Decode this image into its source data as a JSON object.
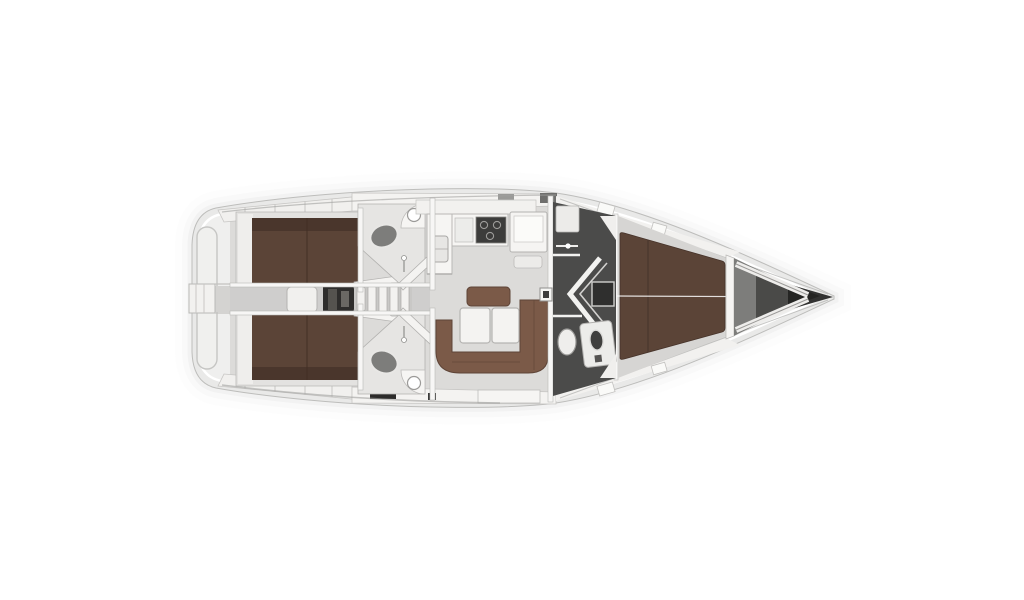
{
  "page": {
    "background": "#ffffff",
    "subject": "sailboat-interior-floor-plan-top-view-bow-right"
  },
  "colors": {
    "hull": "#e9e9e8",
    "hullEdge": "#bdbdbb",
    "deck": "#f3f2f0",
    "deckSeam": "#c7c6c4",
    "floor": "#dcdbd9",
    "corridor": "#d2d1cf",
    "wall": "#f7f6f5",
    "berth": "#5b4437",
    "berthDark": "#4a362c",
    "sofa": "#7b5a48",
    "sofaDark": "#5e4437",
    "table": "#f4f3f1",
    "headRoom": "#4b4b4a",
    "headRoomLine": "#f2f2f0",
    "fixture": "#8f8f8d",
    "toilet": "#efeeec",
    "stove": "#3c3c3b",
    "engine": "#2e2d2c",
    "anchorLocker": "#7d7d7b",
    "anchorInner": "#4a4a48",
    "bowTip": "#222221",
    "shadow": "#d8d8d6"
  },
  "regions": {
    "swim_platform": "swim-platform",
    "aft_cabin_port": "aft-cabin-port",
    "aft_cabin_starboard": "aft-cabin-starboard",
    "engine_compartment": "engine-compartment",
    "companionway_steps": "companionway-steps",
    "aft_head_port": "aft-head-port",
    "aft_head_starboard": "aft-head-starboard",
    "galley": "galley",
    "nav_station": "nav-station",
    "saloon": "saloon",
    "saloon_table": "saloon-table",
    "forward_head": "forward-head",
    "forward_cabin": "forward-cabin",
    "anchor_locker": "anchor-locker",
    "bow": "bow"
  }
}
